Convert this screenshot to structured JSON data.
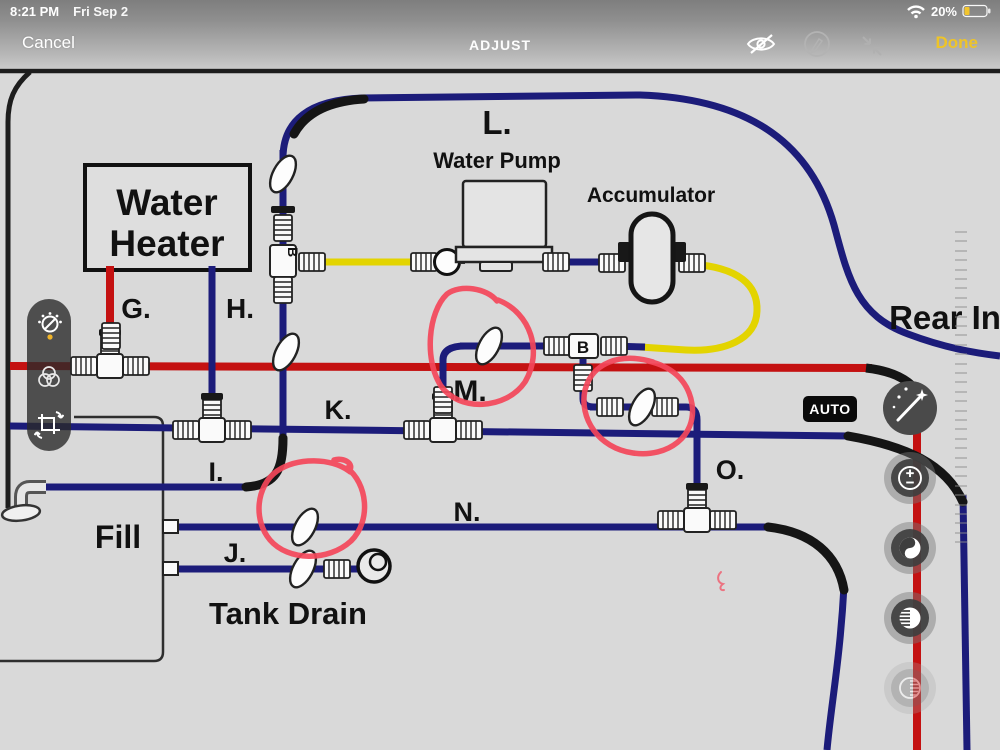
{
  "status_bar": {
    "time": "8:21 PM",
    "date": "Fri Sep 2",
    "battery_percent": "20%"
  },
  "toolbar": {
    "cancel": "Cancel",
    "title": "ADJUST",
    "done": "Done",
    "icons": [
      "visibility-compare",
      "markup-pen",
      "collapse-arrows"
    ]
  },
  "left_toolbar": {
    "tools": [
      "adjust-dial",
      "filters",
      "crop-rotate"
    ],
    "active_tool": "adjust-dial"
  },
  "right_panel": {
    "auto_badge": "AUTO",
    "tools": [
      "auto-enhance-wand",
      "exposure",
      "brilliance",
      "highlights",
      "shadows"
    ]
  },
  "diagram": {
    "labels": {
      "water_heater_1": "Water",
      "water_heater_2": "Heater",
      "water_pump": "Water Pump",
      "accumulator": "Accumulator",
      "fill": "Fill",
      "tank_drain": "Tank Drain",
      "rear_in": "Rear In",
      "b": "B",
      "g": "G.",
      "h": "H.",
      "i": "I.",
      "j": "J.",
      "k": "K.",
      "l": "L.",
      "m": "M.",
      "n": "N.",
      "o": "O."
    },
    "colors": {
      "cold_line": "#1c1c7a",
      "hot_line": "#c41111",
      "pump_line": "#e3d400",
      "annotation": "#f4465a"
    }
  },
  "ui_colors": {
    "done_yellow": "#eec428",
    "battery_low_yellow": "#f2c52e",
    "auto_badge_bg": "#0a0a0a"
  }
}
